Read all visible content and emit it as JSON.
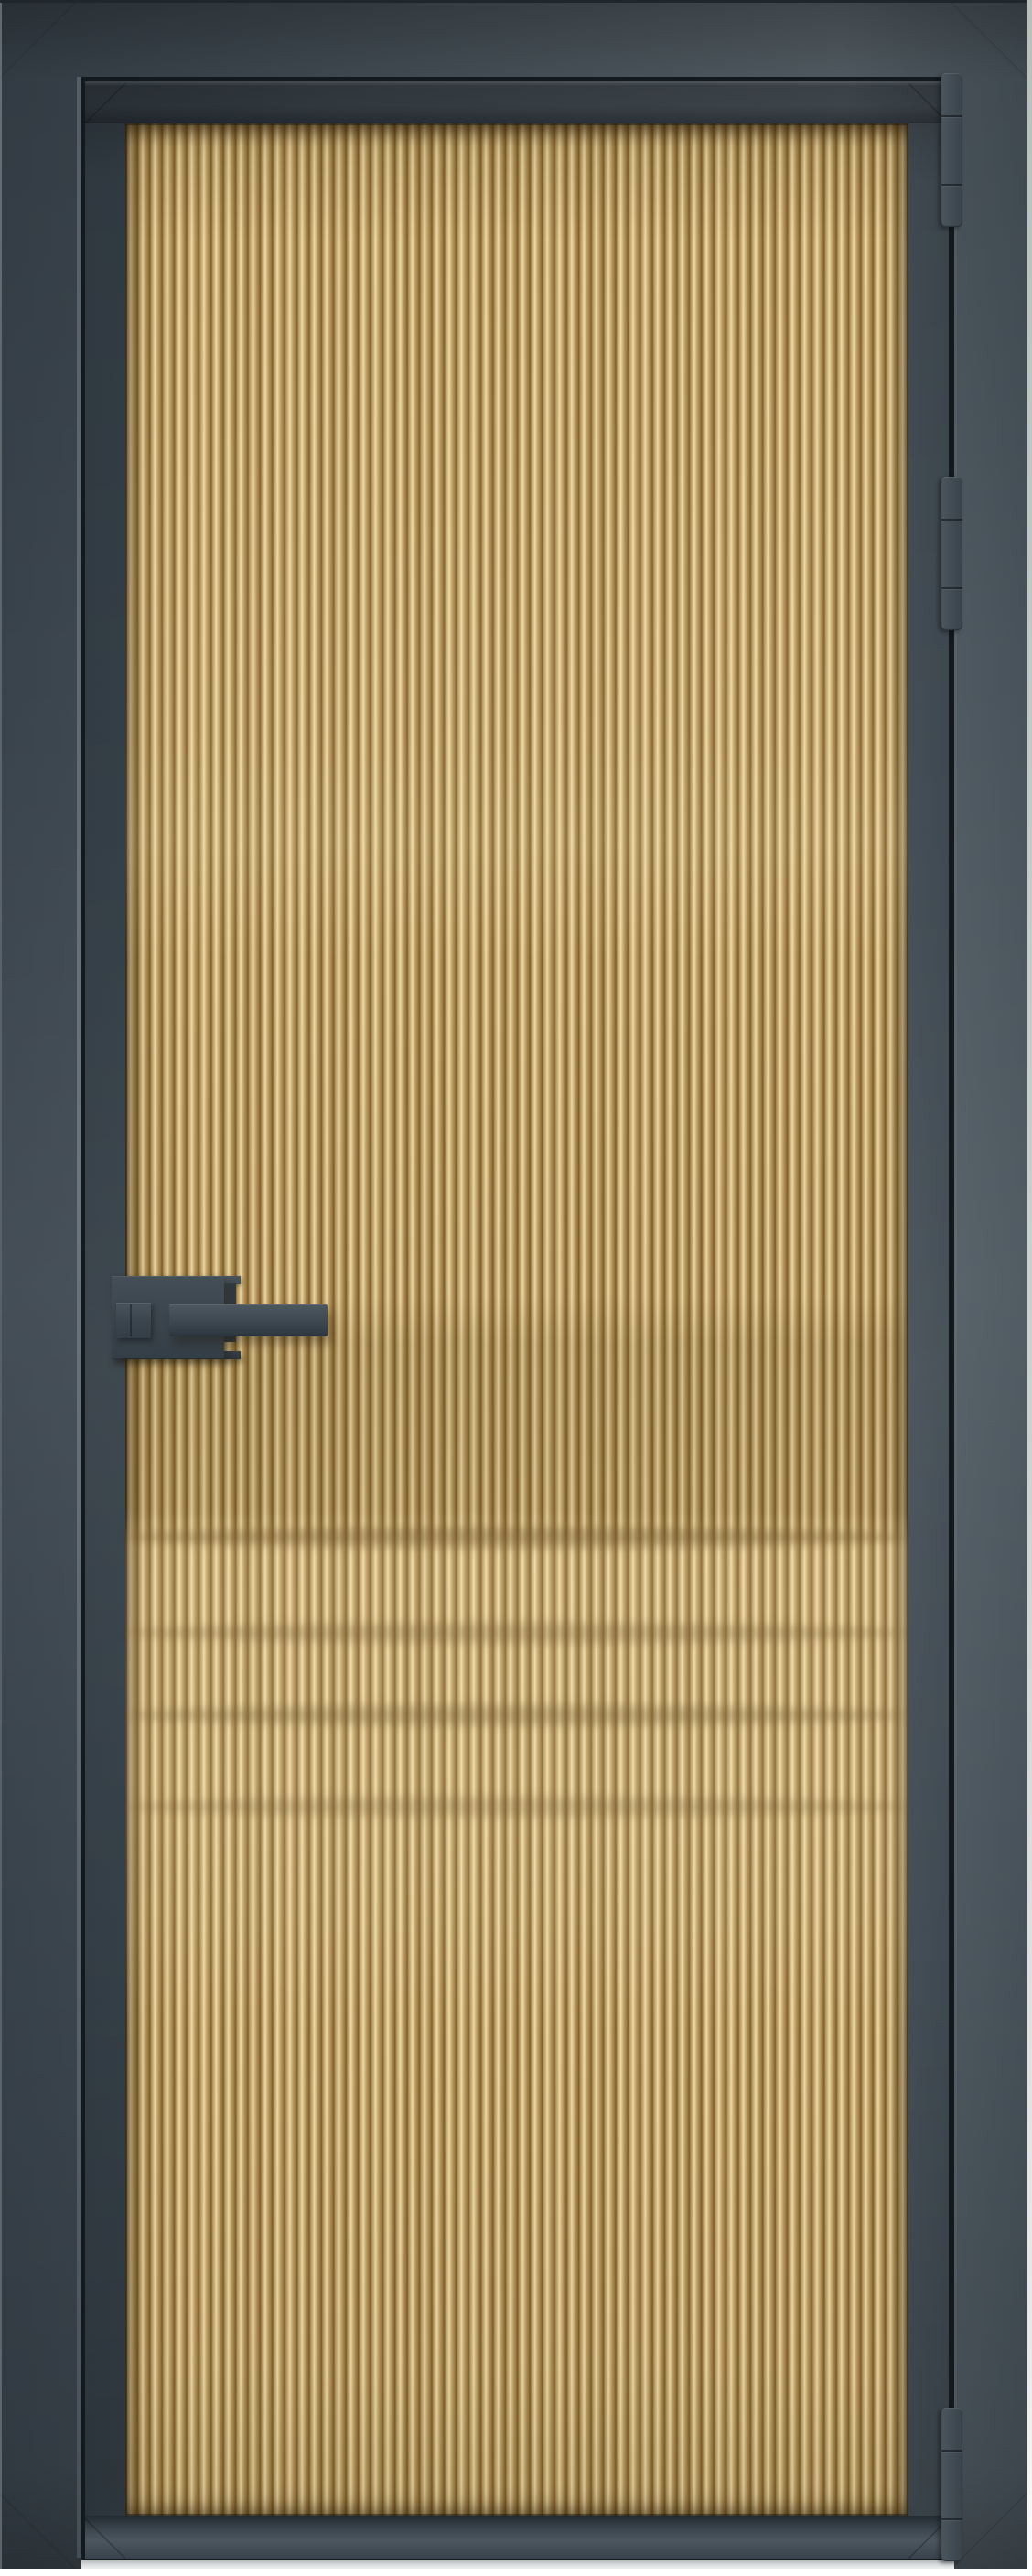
{
  "meta": {
    "type": "product-photo",
    "subject": "Interior aluminium-framed door with fluted gold glass",
    "background": "white studio floor"
  },
  "door": {
    "frame": {
      "material": "aluminium",
      "finish": "graphite grey",
      "casing_visible": true
    },
    "leaf": {
      "glazing": "fluted reeded glass",
      "glass_tint": "gold",
      "flutes_vertical": true,
      "reflection_bands": 4
    },
    "hardware": {
      "handle": {
        "type": "square lever on rectangular backplate",
        "side": "left",
        "finish": "graphite grey"
      },
      "hinges": {
        "count": 3,
        "side": "right",
        "segments_per_hinge": 3,
        "finish": "graphite grey"
      }
    }
  },
  "palette": {
    "bg": "#ffffff",
    "casing-base": "#47525a",
    "casing-light": "#5a656c",
    "casing-dark": "#39434c",
    "leaf-base": "#3f4951",
    "leaf-light": "#4e585f",
    "leaf-dark": "#333d45",
    "seam": "#14191d",
    "hardware": "#3b454d",
    "glass-groove": "#7a5c2b",
    "glass-mid": "#b3945a",
    "glass-ridge": "#d6bd85",
    "glass-bright": "#eedcab",
    "glass-mid2": "#98783f",
    "floor-shadow": "#aeb3b6",
    "photo-edge": "#cdd2cc"
  }
}
